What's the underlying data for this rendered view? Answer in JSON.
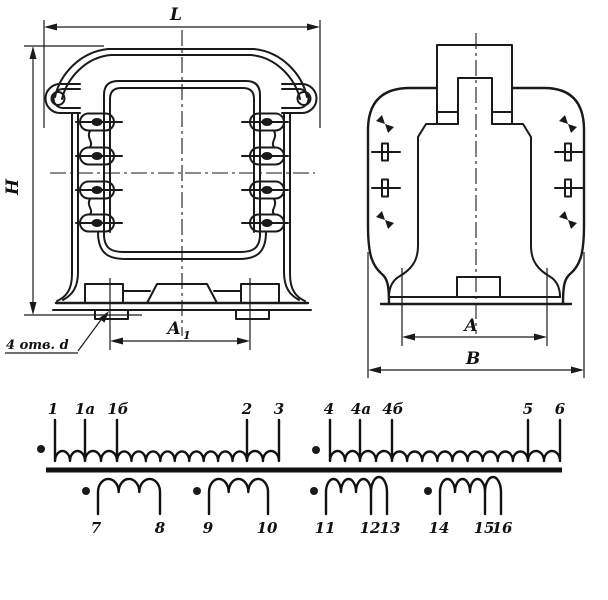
{
  "drawing": {
    "colors": {
      "ink": "#1a1a1a",
      "paper": "#ffffff"
    },
    "dimensions": {
      "length": "L",
      "height": "Н",
      "foot_span_main": "А",
      "foot_span_sub": "1",
      "depth_inner": "А",
      "depth_outer": "В",
      "holes_note": "4 отв. d"
    },
    "schematic": {
      "top_terminals": [
        "1",
        "1а",
        "1б",
        "2",
        "3",
        "4",
        "4а",
        "4б",
        "5",
        "6"
      ],
      "bottom_terminals": [
        "7",
        "8",
        "9",
        "10",
        "11",
        "12",
        "13",
        "14",
        "15",
        "16"
      ]
    }
  }
}
